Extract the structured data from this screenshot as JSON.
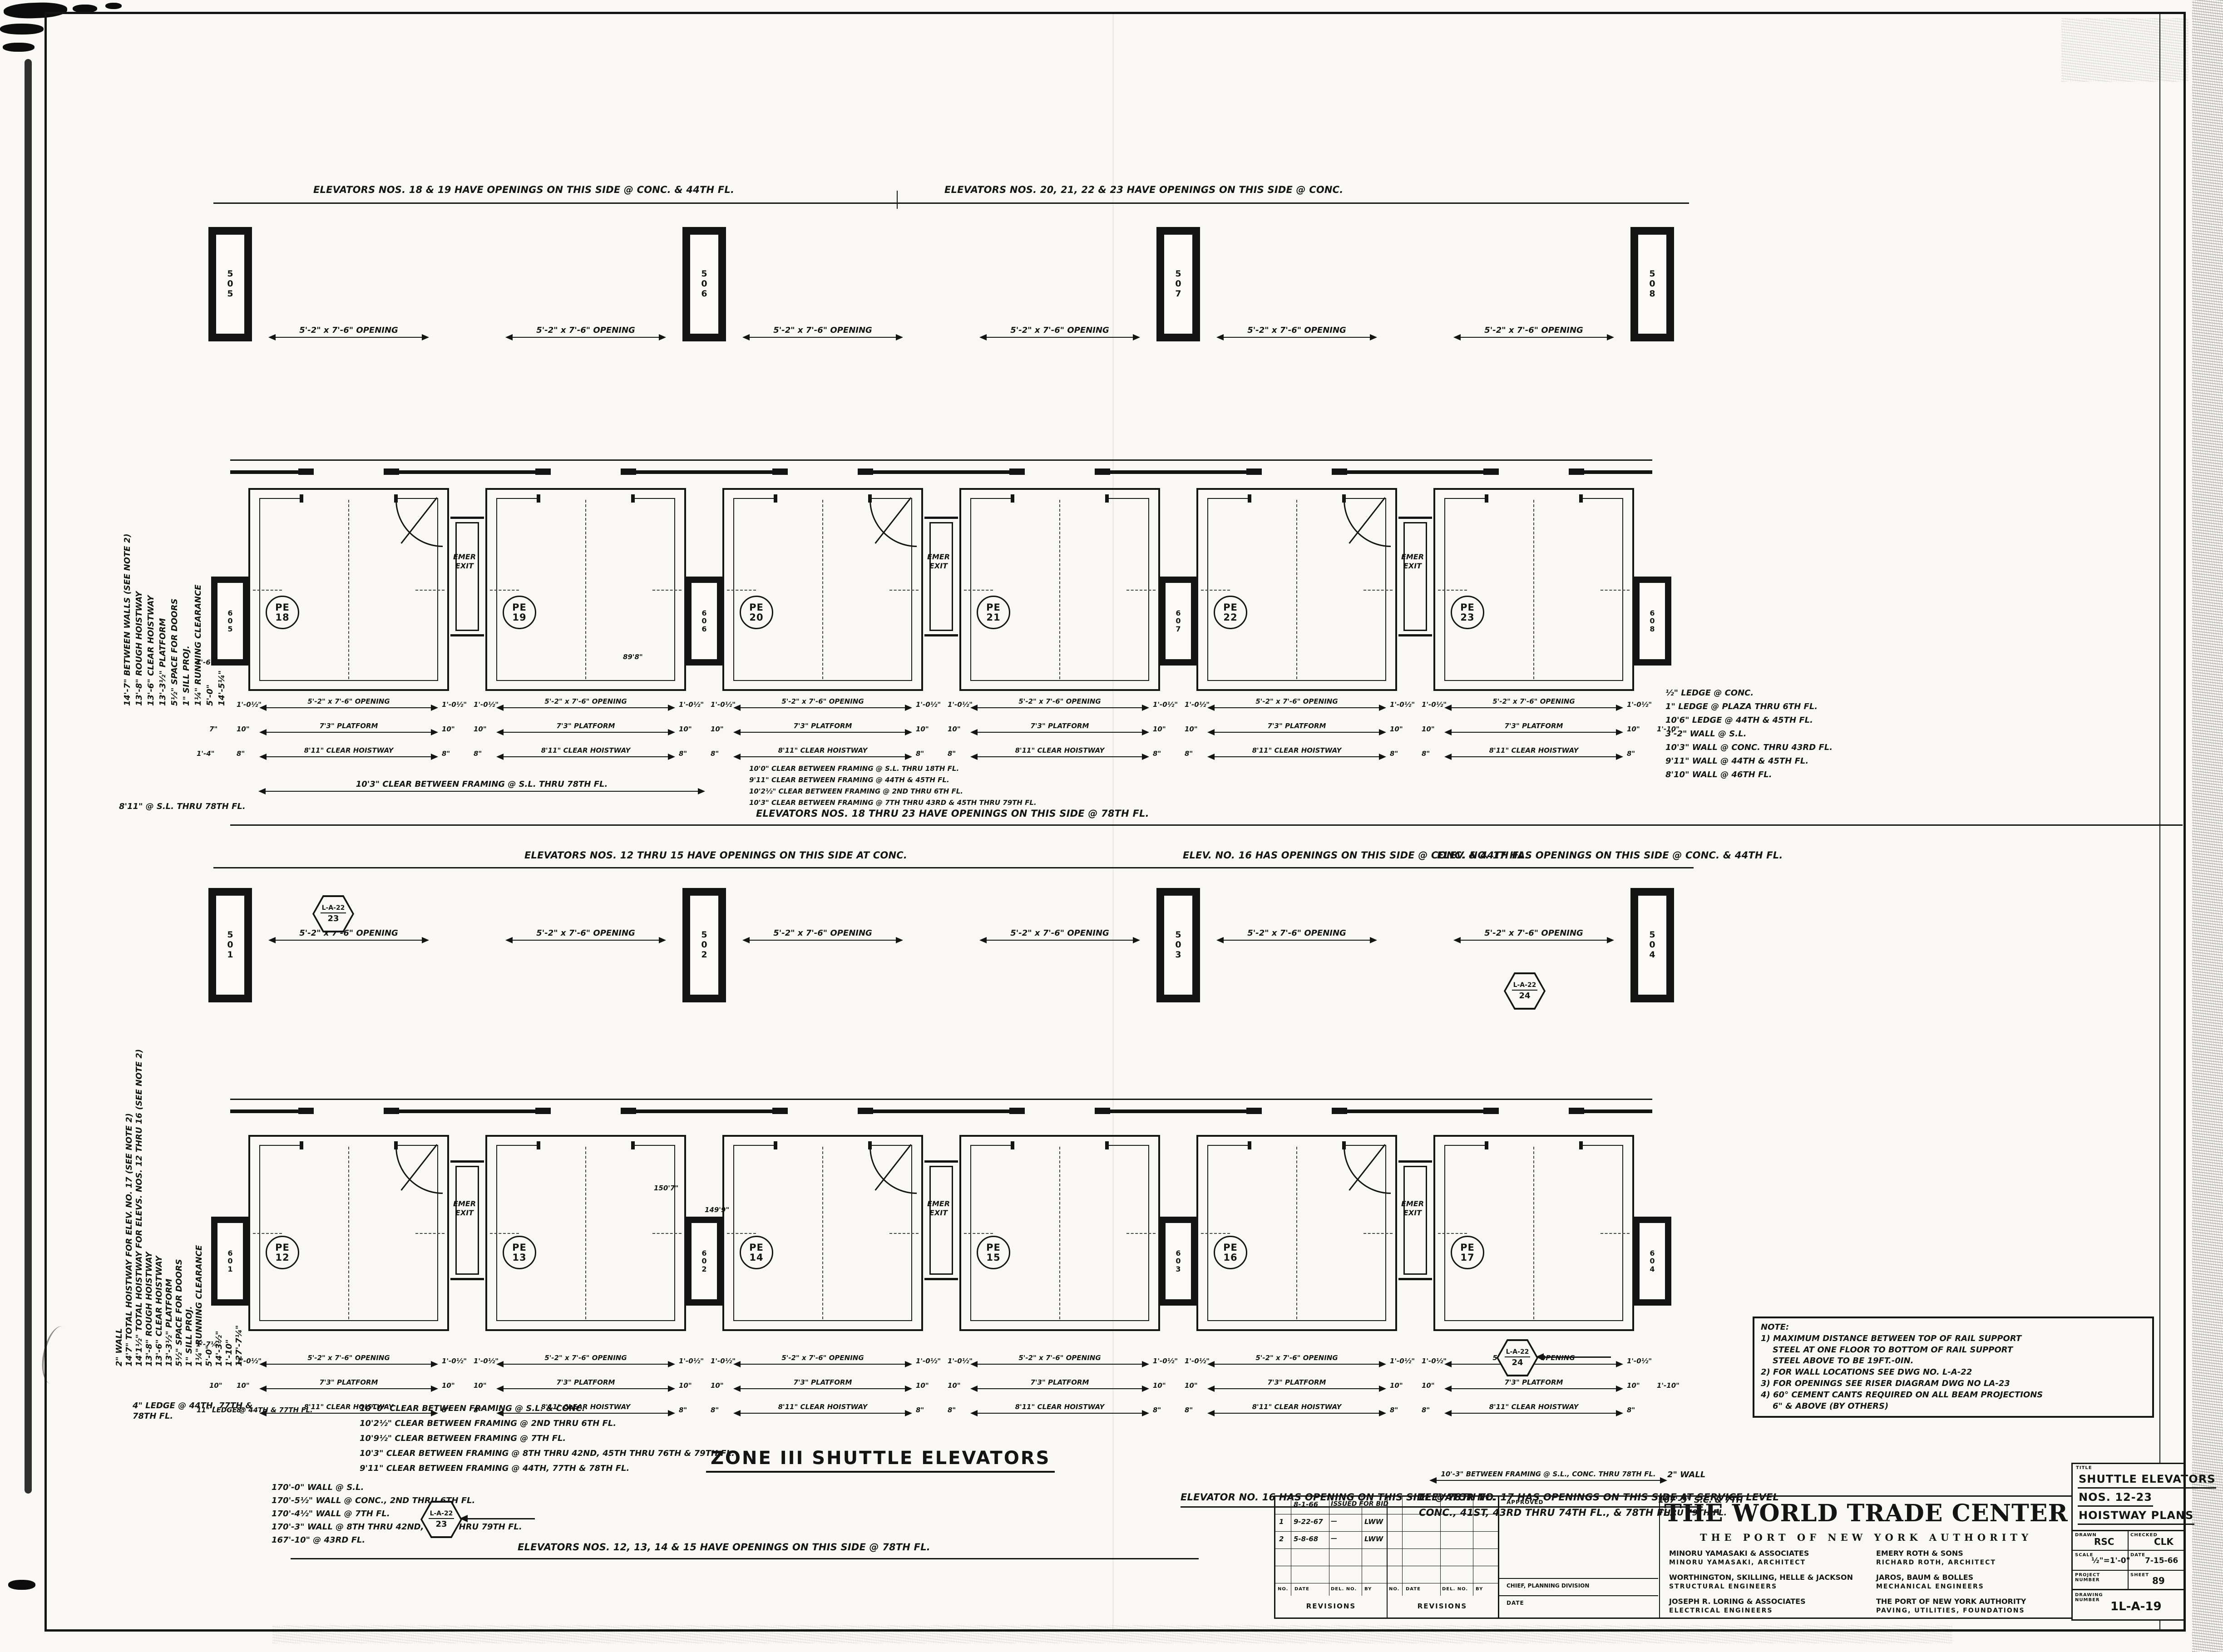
{
  "sheet": {
    "paper": "#f9f8f4",
    "ink": "#141414"
  },
  "zone_title": "ZONE III SHUTTLE ELEVATORS",
  "banners": {
    "top_strip_top_left": "ELEVATORS NOS. 18 & 19 HAVE OPENINGS ON THIS SIDE @ CONC. & 44TH FL.",
    "top_strip_top_right": "ELEVATORS NOS. 20, 21, 22 & 23 HAVE OPENINGS ON THIS SIDE @ CONC.",
    "top_strip_bottom": "ELEVATORS NOS. 18 THRU 23 HAVE OPENINGS ON THIS SIDE @ 78TH FL.",
    "bottom_strip_top_left": "ELEVATORS NOS. 12 THRU 15 HAVE OPENINGS ON THIS SIDE AT CONC.",
    "bottom_strip_top_mid": "ELEV. NO. 16 HAS OPENINGS ON THIS SIDE @ CONC. & 44TH FL.",
    "bottom_strip_top_right": "ELEV. NO. 17 HAS OPENINGS ON THIS SIDE @ CONC. & 44TH FL.",
    "bottom_strip_bottom_left": "ELEVATOR NO. 16 HAS OPENING ON THIS SIDE @ 78TH FL.",
    "bottom_strip_bottom_mid_1": "ELEVATOR NO. 17 HAS OPENINGS ON THIS SIDE AT SERVICE LEVEL",
    "bottom_strip_bottom_mid_2": "CONC., 41ST, 43RD THRU 74TH FL., & 78TH FL.",
    "bottom_strip_bottom_center": "ELEVATORS NOS. 12, 13, 14 & 15 HAVE OPENINGS ON THIS SIDE @ 78TH FL."
  },
  "strips": [
    {
      "id": "top",
      "columns_top": [
        "505",
        "506",
        "507",
        "508"
      ],
      "columns_bottom": [
        "605",
        "606",
        "607",
        "608"
      ],
      "cells": [
        {
          "tag": "PE",
          "num": "18",
          "opening": "5'-2\" x 7'-6\" OPENING",
          "emer": true
        },
        {
          "tag": "PE",
          "num": "19",
          "opening": "5'-2\" x 7'-6\" OPENING",
          "emer": false
        },
        {
          "tag": "PE",
          "num": "20",
          "opening": "5'-2\" x 7'-6\" OPENING",
          "emer": true
        },
        {
          "tag": "PE",
          "num": "21",
          "opening": "5'-2\" x 7'-6\" OPENING",
          "emer": false
        },
        {
          "tag": "PE",
          "num": "22",
          "opening": "5'-2\" x 7'-6\" OPENING",
          "emer": true
        },
        {
          "tag": "PE",
          "num": "23",
          "opening": "5'-2\" x 7'-6\" OPENING",
          "emer": false
        }
      ],
      "dims": {
        "opening": "5'-2\" x 7'-6\" OPENING",
        "opening_flank": "1'-0½\"",
        "platform": "7'3\" PLATFORM",
        "platform_flank": "10\"",
        "hoistway": "8'11\" CLEAR HOISTWAY",
        "hoistway_flank": "8\"",
        "edge_left": "7\"",
        "edge_left2": "1'-4\"",
        "edge_right": "1'-10\""
      },
      "emer_label": "EMER EXIT",
      "framing_note": "10'3\" CLEAR BETWEEN FRAMING @ S.L. THRU 78TH FL.",
      "framing_note_2": "8'11\" @ S.L. THRU 78TH FL."
    },
    {
      "id": "bottom",
      "columns_top": [
        "501",
        "502",
        "503",
        "504"
      ],
      "columns_bottom": [
        "601",
        "602",
        "603",
        "604"
      ],
      "cells": [
        {
          "tag": "PE",
          "num": "12",
          "opening": "5'-2\" x 7'-6\" OPENING",
          "emer": true
        },
        {
          "tag": "PE",
          "num": "13",
          "opening": "5'-2\" x 7'-6\" OPENING",
          "emer": false
        },
        {
          "tag": "PE",
          "num": "14",
          "opening": "5'-2\" x 7'-6\" OPENING",
          "emer": true
        },
        {
          "tag": "PE",
          "num": "15",
          "opening": "5'-2\" x 7'-6\" OPENING",
          "emer": false
        },
        {
          "tag": "PE",
          "num": "16",
          "opening": "5'-2\" x 7'-6\" OPENING",
          "emer": true
        },
        {
          "tag": "PE",
          "num": "17",
          "opening": "5'-2\" x 7'-6\" OPENING",
          "emer": false
        }
      ],
      "dims": {
        "opening": "5'-2\" x 7'-6\" OPENING",
        "opening_flank": "1'-0½\"",
        "platform": "7'3\" PLATFORM",
        "platform_flank": "10\"",
        "hoistway": "8'11\" CLEAR HOISTWAY",
        "hoistway_flank": "8\"",
        "edge_left": "10\"",
        "edge_left2": "11\" LEDGE @ 44TH & 77TH FL.",
        "edge_right": "1'-10\""
      },
      "emer_label": "EMER EXIT",
      "framing_note": "10'-3\" BETWEEN FRAMING @ S.L., CONC. THRU 78TH FL.",
      "framing_note_2": ""
    }
  ],
  "side_labels_top": [
    "14'-7\" BETWEEN WALLS (SEE NOTE 2)",
    "13'-8\" ROUGH HOISTWAY",
    "13'-6\" CLEAR HOISTWAY",
    "13'-3½\" PLATFORM",
    "5½\" SPACE FOR DOORS",
    "1\" SILL PROJ.",
    "1¼\" RUNNING CLEARANCE",
    "5'-0\"",
    "14'-5¼\""
  ],
  "side_labels_bottom": [
    "2\" WALL",
    "14'7\" TOTAL HOISTWAY FOR ELEV. NO. 17 (SEE NOTE 2)",
    "14'1½\" TOTAL HOISTWAY FOR ELEVS. NOS. 12 THRU 16 (SEE NOTE 2)",
    "13'-8\" ROUGH HOISTWAY",
    "13'-6\" CLEAR HOISTWAY",
    "13'-3½\" PLATFORM",
    "5½\" SPACE FOR DOORS",
    "1\" SILL PROJ.",
    "1¼\" RUNNING CLEARANCE",
    "5'-0\"",
    "14'-3½\"",
    "1'-10\"",
    "127'-7¼\""
  ],
  "notes": {
    "top_right": [
      "10'0\" CLEAR BETWEEN FRAMING @ S.L. THRU 18TH FL.",
      "9'11\" CLEAR BETWEEN FRAMING @ 44TH & 45TH FL.",
      "10'2½\" CLEAR BETWEEN FRAMING @ 2ND THRU 6TH FL.",
      "10'3\" CLEAR BETWEEN FRAMING @ 7TH THRU 43RD & 45TH THRU 79TH FL."
    ],
    "top_right_edge": [
      "½\" LEDGE @ CONC.",
      "1\" LEDGE @ PLAZA THRU 6TH FL.",
      "10'6\" LEDGE @ 44TH & 45TH FL.",
      "3'-2\" WALL @ S.L.",
      "10'3\" WALL @ CONC. THRU 43RD FL.",
      "9'11\" WALL @ 44TH & 45TH FL.",
      "8'10\" WALL @ 46TH FL."
    ],
    "bottom_left_ledge": "4\" LEDGE @ 44TH, 77TH & 78TH FL.",
    "bottom_left_framing": [
      "10'-0\" CLEAR BETWEEN FRAMING @ S.L. & CONC.",
      "10'2½\" CLEAR BETWEEN FRAMING @ 2ND THRU 6TH FL.",
      "10'9½\" CLEAR BETWEEN FRAMING @ 7TH FL.",
      "10'3\" CLEAR BETWEEN FRAMING @ 8TH THRU 42ND, 45TH THRU 76TH & 79TH FL.",
      "9'11\" CLEAR BETWEEN FRAMING @ 44TH, 77TH & 78TH FL."
    ],
    "bottom_left_walls": [
      "170'-0\" WALL @ S.L.",
      "170'-5½\" WALL @ CONC., 2ND THRU 6TH FL.",
      "170'-4½\" WALL @ 7TH FL.",
      "170'-3\" WALL @ 8TH THRU 42ND, 44TH THRU 79TH FL.",
      "167'-10\" @ 43RD FL."
    ],
    "bottom_right": [
      "2\" WALL",
      "107'-3\" S.C. & 7TH",
      "THRU 79TH FL."
    ],
    "misc_dims": [
      "89'8\"",
      "150'7\"",
      "149'9\"",
      "1'-6½\"",
      "1'-7¼\""
    ]
  },
  "note_box": {
    "heading": "NOTE:",
    "lines": [
      "1) MAXIMUM DISTANCE BETWEEN TOP OF RAIL SUPPORT",
      "STEEL AT ONE FLOOR TO BOTTOM OF RAIL SUPPORT",
      "STEEL ABOVE TO BE 19FT.-0IN.",
      "2) FOR WALL LOCATIONS SEE DWG NO. L-A-22",
      "3) FOR OPENINGS SEE RISER DIAGRAM DWG NO LA-23",
      "4) 60° CEMENT CANTS REQUIRED ON ALL BEAM PROJECTIONS",
      "6\" & ABOVE (BY OTHERS)"
    ]
  },
  "ref_tags": [
    {
      "top": "L-A-22",
      "bottom": "23"
    },
    {
      "top": "L-A-22",
      "bottom": "24"
    },
    {
      "top": "L-A-22",
      "bottom": "24"
    },
    {
      "top": "L-A-22",
      "bottom": "23"
    }
  ],
  "revisions": {
    "cols": [
      "NO.",
      "DATE",
      "DEL. NO.",
      "BY"
    ],
    "entries": [
      [
        "",
        "8-1-66",
        "ISSUED FOR BID",
        ""
      ],
      [
        "1",
        "9-22-67",
        "—",
        "LWW"
      ],
      [
        "2",
        "5-8-68",
        "—",
        "LWW"
      ]
    ],
    "label": "REVISIONS"
  },
  "approved": {
    "label": "APPROVED",
    "chief": "CHIEF, PLANNING DIVISION",
    "date_label": "DATE"
  },
  "title_block": {
    "project": "THE WORLD TRADE CENTER",
    "authority": "THE PORT OF NEW YORK AUTHORITY",
    "firms": [
      {
        "name": "MINORU YAMASAKI & ASSOCIATES",
        "role": "MINORU YAMASAKI, ARCHITECT"
      },
      {
        "name": "EMERY ROTH & SONS",
        "role": "RICHARD ROTH, ARCHITECT"
      },
      {
        "name": "WORTHINGTON, SKILLING, HELLE & JACKSON",
        "role": "STRUCTURAL ENGINEERS"
      },
      {
        "name": "JAROS, BAUM & BOLLES",
        "role": "MECHANICAL ENGINEERS"
      },
      {
        "name": "JOSEPH R. LORING & ASSOCIATES",
        "role": "ELECTRICAL ENGINEERS"
      },
      {
        "name": "THE PORT OF NEW YORK AUTHORITY",
        "role": "PAVING, UTILITIES, FOUNDATIONS"
      }
    ],
    "title_label": "TITLE",
    "title_lines": [
      "SHUTTLE ELEVATORS",
      "NOS. 12-23",
      "HOISTWAY PLANS"
    ],
    "drawn_label": "DRAWN",
    "drawn": "RSC",
    "checked_label": "CHECKED",
    "checked": "CLK",
    "scale_label": "SCALE",
    "scale": "½\"=1'-0\"",
    "date_label": "DATE",
    "date": "7-15-66",
    "project_number_label": "PROJECT NUMBER",
    "sheet_label": "SHEET",
    "sheet": "89",
    "drawing_number_label": "DRAWING NUMBER",
    "drawing_number": "1L-A-19"
  }
}
